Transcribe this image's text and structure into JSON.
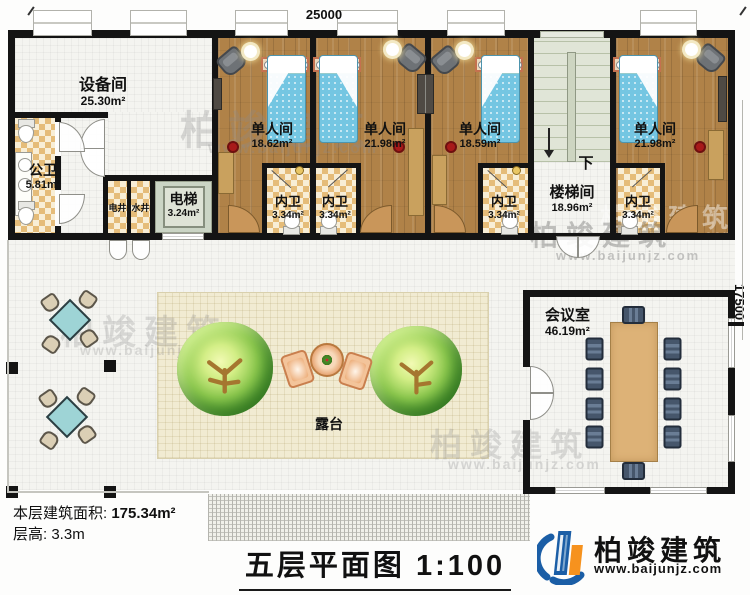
{
  "dimensions": {
    "width": "25000",
    "height": "17500"
  },
  "rooms": {
    "equipment": {
      "name": "设备间",
      "area": "25.30m²"
    },
    "public_wc": {
      "name": "公卫",
      "area": "5.81m²"
    },
    "elec_shaft": {
      "name": "电井"
    },
    "water_shaft": {
      "name": "水井"
    },
    "elevator": {
      "name": "电梯",
      "area": "3.24m²"
    },
    "single1": {
      "name": "单人间",
      "area": "18.62m²"
    },
    "single2": {
      "name": "单人间",
      "area": "21.98m²"
    },
    "single3": {
      "name": "单人间",
      "area": "18.59m²"
    },
    "single4": {
      "name": "单人间",
      "area": "21.98m²"
    },
    "wc1": {
      "name": "内卫",
      "area": "3.34m²"
    },
    "wc2": {
      "name": "内卫",
      "area": "3.34m²"
    },
    "wc3": {
      "name": "内卫",
      "area": "3.34m²"
    },
    "wc4": {
      "name": "内卫",
      "area": "3.34m²"
    },
    "stair": {
      "name": "楼梯间",
      "area": "18.96m²",
      "down": "下"
    },
    "meeting": {
      "name": "会议室",
      "area": "46.19m²"
    },
    "terrace": {
      "name": "露台"
    }
  },
  "info": {
    "floor_area_label": "本层建筑面积:",
    "floor_area_value": "175.34m²",
    "floor_height_label": "层高:",
    "floor_height_value": "3.3m"
  },
  "title": {
    "name": "五层平面图",
    "scale": "1:100"
  },
  "brand": {
    "name": "柏竣建筑",
    "url": "www.baijunjz.com",
    "blue": "#1b5ea6",
    "orange": "#f6921e"
  },
  "watermark": {
    "name": "柏竣建筑",
    "url": "www.baijunjz.com"
  }
}
